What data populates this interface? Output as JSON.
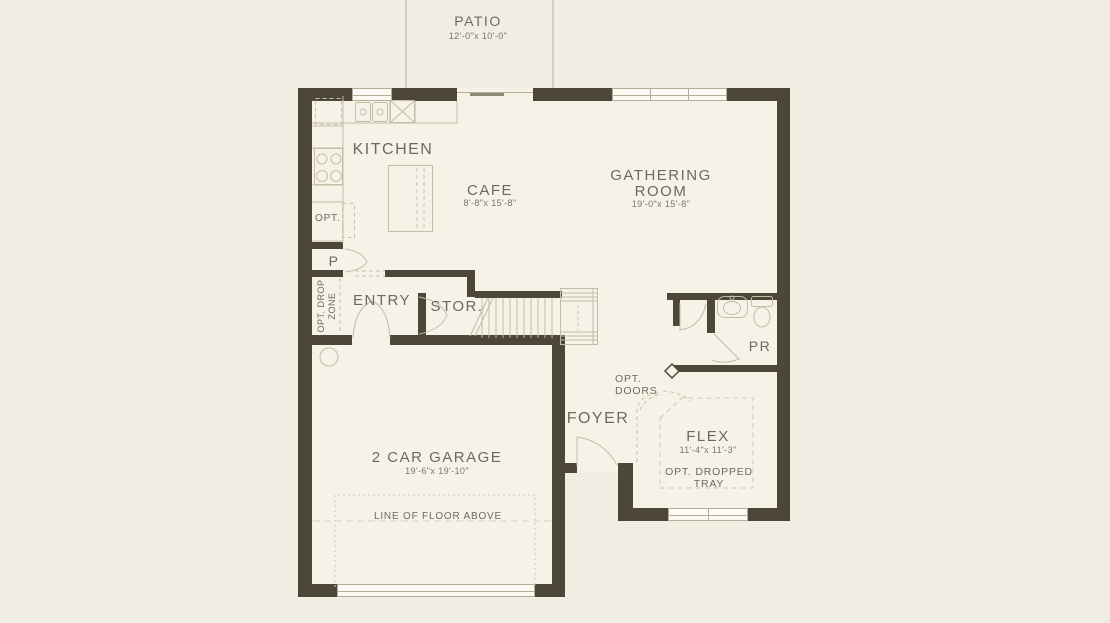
{
  "plan": {
    "rooms": {
      "patio": {
        "label": "PATIO",
        "dims": "12'-0\"x 10'-0\""
      },
      "kitchen": {
        "label": "KITCHEN"
      },
      "cafe": {
        "label": "CAFE",
        "dims": "8'-8\"x 15'-8\""
      },
      "gathering": {
        "label_line1": "GATHERING",
        "label_line2": "ROOM",
        "dims": "19'-0\"x 15'-8\""
      },
      "pantry": {
        "label": "P"
      },
      "drop_zone": {
        "label_line1": "OPT. DROP",
        "label_line2": "ZONE"
      },
      "entry": {
        "label": "ENTRY"
      },
      "storage": {
        "label": "STOR."
      },
      "powder": {
        "label": "PR"
      },
      "foyer": {
        "label": "FOYER"
      },
      "flex": {
        "label": "FLEX",
        "dims": "11'-4\"x 11'-3\"",
        "tray_note_line1": "OPT. DROPPED",
        "tray_note_line2": "TRAY"
      },
      "garage": {
        "label": "2 CAR GARAGE",
        "dims": "19'-6\"x 19'-10\"",
        "floor_note": "LINE OF FLOOR ABOVE"
      }
    },
    "annotations": {
      "opt_appliance": "OPT.",
      "opt_doors_line1": "OPT.",
      "opt_doors_line2": "DOORS"
    },
    "colors": {
      "wall": "#4e4639",
      "background": "#f0ede2",
      "floor": "#f5f2e7",
      "thin_line": "#c3bca7",
      "text": "#6e695e"
    }
  }
}
